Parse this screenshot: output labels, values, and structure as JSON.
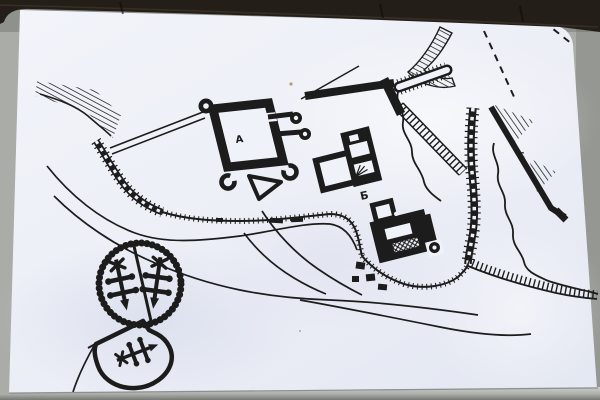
{
  "scene": {
    "description": "Photograph of a notice board: hand-drawn castle site plan in black ink on a white sheet, dark wooden frame strip at top, grey board visible at edges and bottom",
    "colors": {
      "frame": "#241e19",
      "board": "#a9aca7",
      "board_dark": "#83867f",
      "strip_light": "#c9ccc7",
      "strip_dark": "#8d908b",
      "paper": "#eef0f7",
      "paper_shade": "#dce1ee",
      "ink": "#1c1c1c",
      "speck": "#b98a50"
    }
  },
  "map": {
    "labels": [
      {
        "text": "A"
      },
      {
        "text": "Б"
      },
      {
        "text": "c"
      }
    ],
    "features": [
      "escarpment-hatching-northwest",
      "double-line-bridge",
      "square-keep-with-corner-ring-towers",
      "twin-tower-gatehouse",
      "triangular-outwork",
      "ruined-wall-arc-with-block-fragments",
      "serrated-palisade-line",
      "building-b-with-two-courts",
      "black-building-complex-with-crosshatched-range",
      "long-chain-masonry-wall",
      "toothed-stockade-enclosure",
      "thick-rampart-bars",
      "hatched-stepped-ramp-bands",
      "wall-c-with-hatched-scarp-triangles",
      "dashed-boundary-lines",
      "wavy-stream-lines",
      "terrain-path-lines",
      "heraldic-wreath-with-two-crosses",
      "heraldic-shield-with-key"
    ]
  }
}
